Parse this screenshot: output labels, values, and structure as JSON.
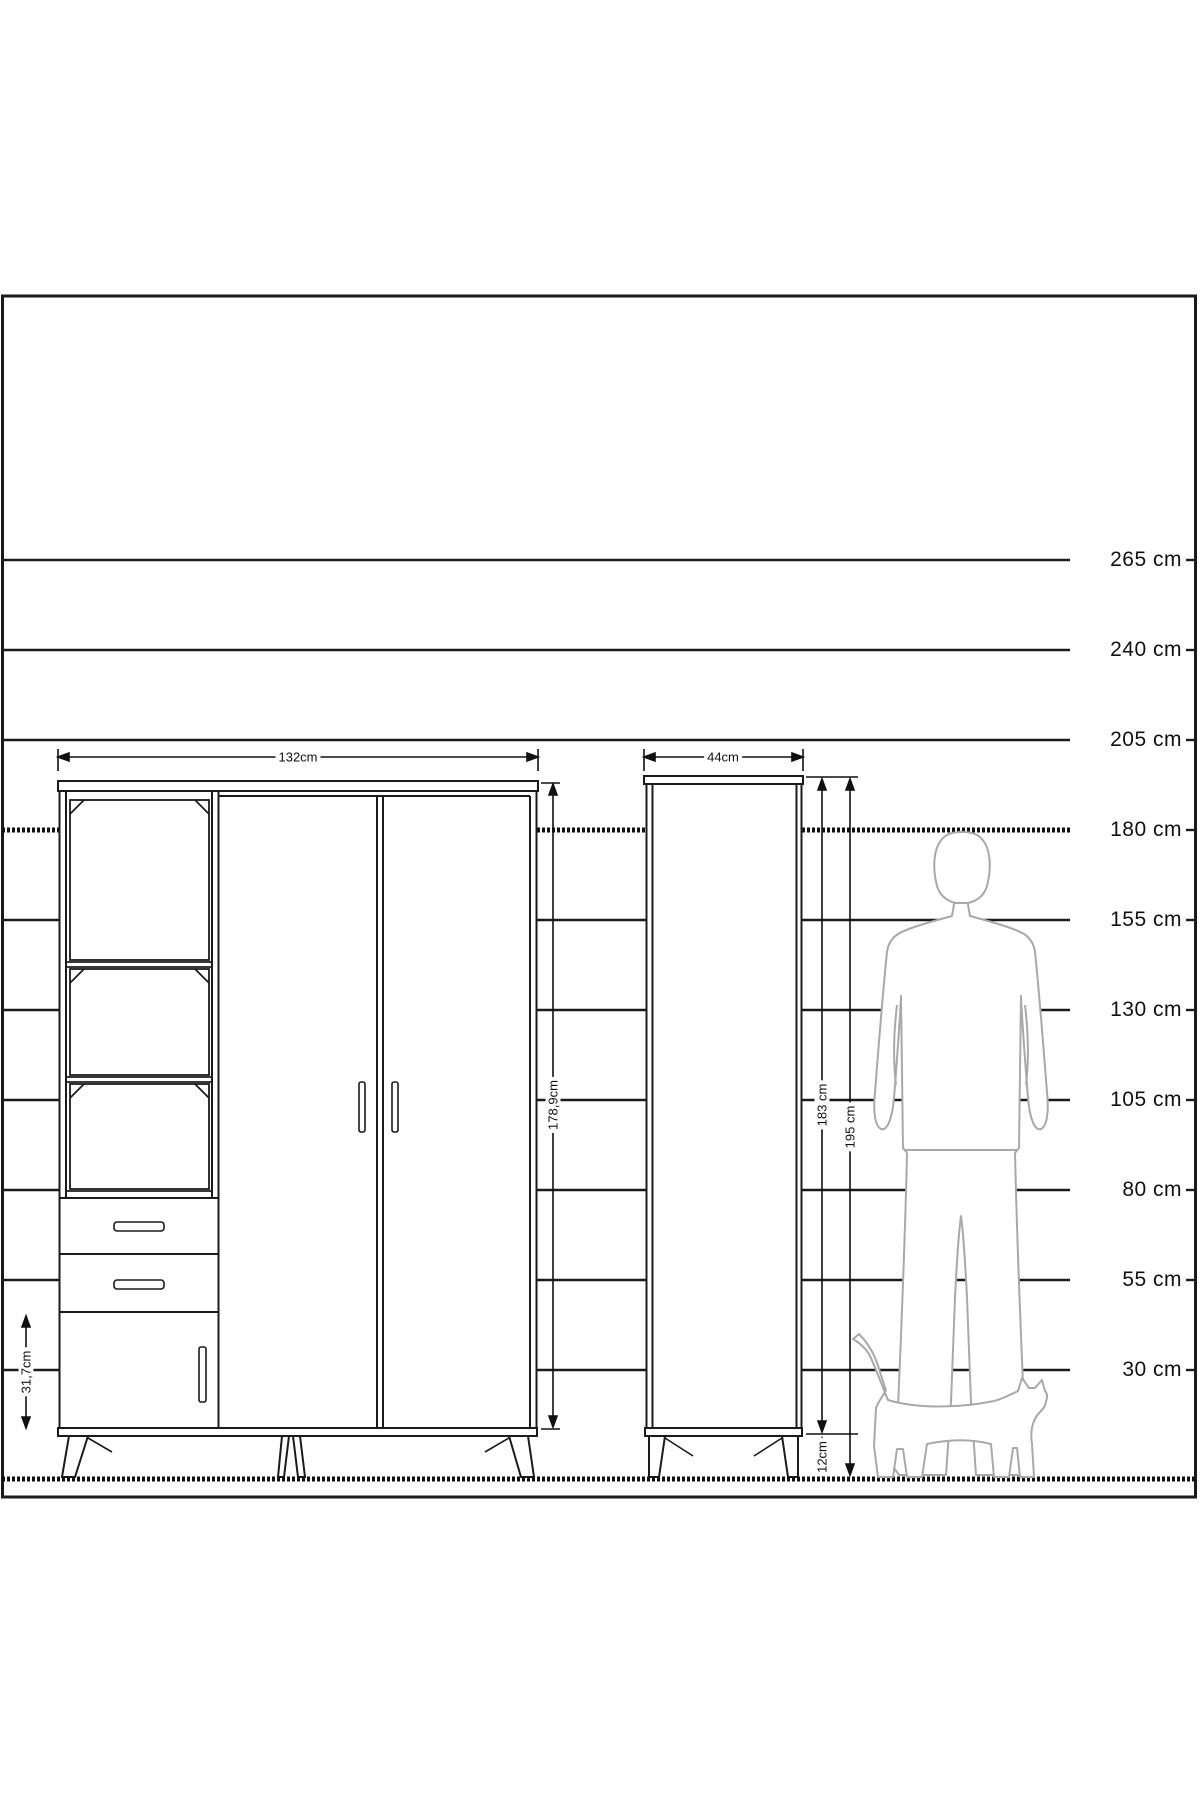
{
  "colors": {
    "line": "#1b1b1b",
    "figure_outline": "#a9a9a9",
    "background": "#ffffff"
  },
  "scale_labels": [
    "265 cm",
    "240 cm",
    "205 cm",
    "180 cm",
    "155 cm",
    "130 cm",
    "105 cm",
    "80 cm",
    "55 cm",
    "30 cm"
  ],
  "wardrobe": {
    "width_label": "132cm",
    "height_label": "178,9cm",
    "door_height_label": "31,7cm"
  },
  "cabinet": {
    "width_label": "44cm",
    "body_height_label": "183 cm",
    "total_height_label": "195 cm",
    "leg_height_label": "12cm"
  }
}
